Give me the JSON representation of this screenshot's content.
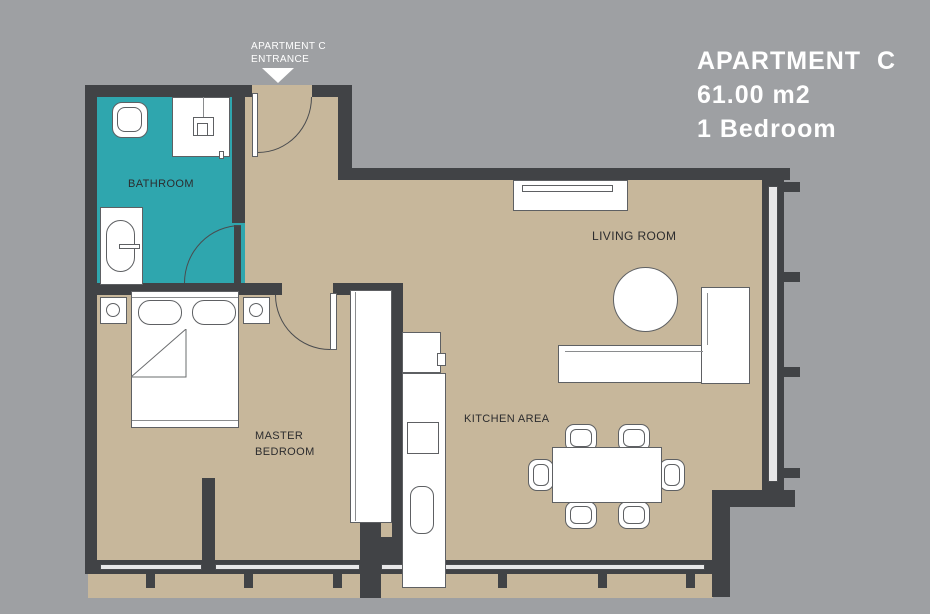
{
  "title_block": {
    "name": "APARTMENT  C",
    "area": "61.00 m2",
    "bedrooms": "1 Bedroom"
  },
  "entrance": {
    "label": "APARTMENT C\nENTRANCE"
  },
  "room_labels": {
    "bathroom": "BATHROOM",
    "master_bedroom": "MASTER\nBEDROOM",
    "living_room": "LIVING ROOM",
    "kitchen": "KITCHEN AREA"
  },
  "colors": {
    "bg": "#9EA0A3",
    "wall": "#414346",
    "floor": "#C7B79B",
    "teal": "#2FA6AE",
    "window": "#E8E8E9",
    "line": "#5E6063",
    "label": "#2C2C2E",
    "title": "#FFFFFF"
  }
}
